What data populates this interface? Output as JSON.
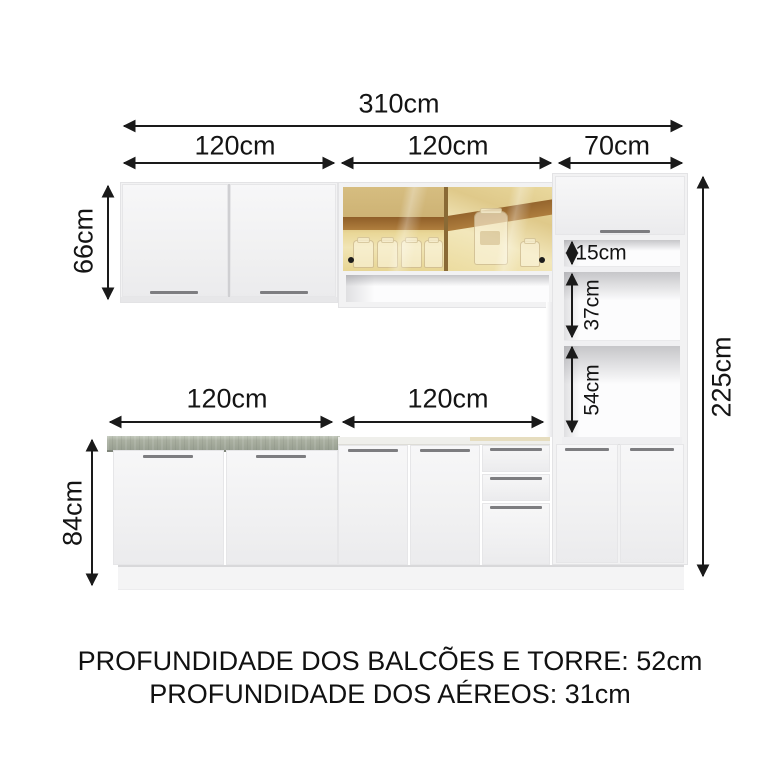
{
  "diagram": {
    "dims": {
      "total_width": "310cm",
      "upper_left": "120cm",
      "upper_middle": "120cm",
      "upper_right": "70cm",
      "aerial_height": "66cm",
      "base_height": "84cm",
      "total_height": "225cm",
      "tower_niche_top": "15cm",
      "tower_niche_middle": "37cm",
      "tower_niche_bottom": "54cm",
      "base_left": "120cm",
      "base_middle": "120cm"
    },
    "footer": {
      "line1": "PROFUNDIDADE DOS BALCÕES E TORRE: 52cm",
      "line2": "PROFUNDIDADE DOS AÉREOS: 31cm"
    },
    "colors": {
      "ink": "#141414",
      "cabinet_white": "#f2f2f3",
      "glass_amber": "#d9c182",
      "wood_brown": "#a5702f",
      "countertop_gray": "#a2a898"
    }
  }
}
